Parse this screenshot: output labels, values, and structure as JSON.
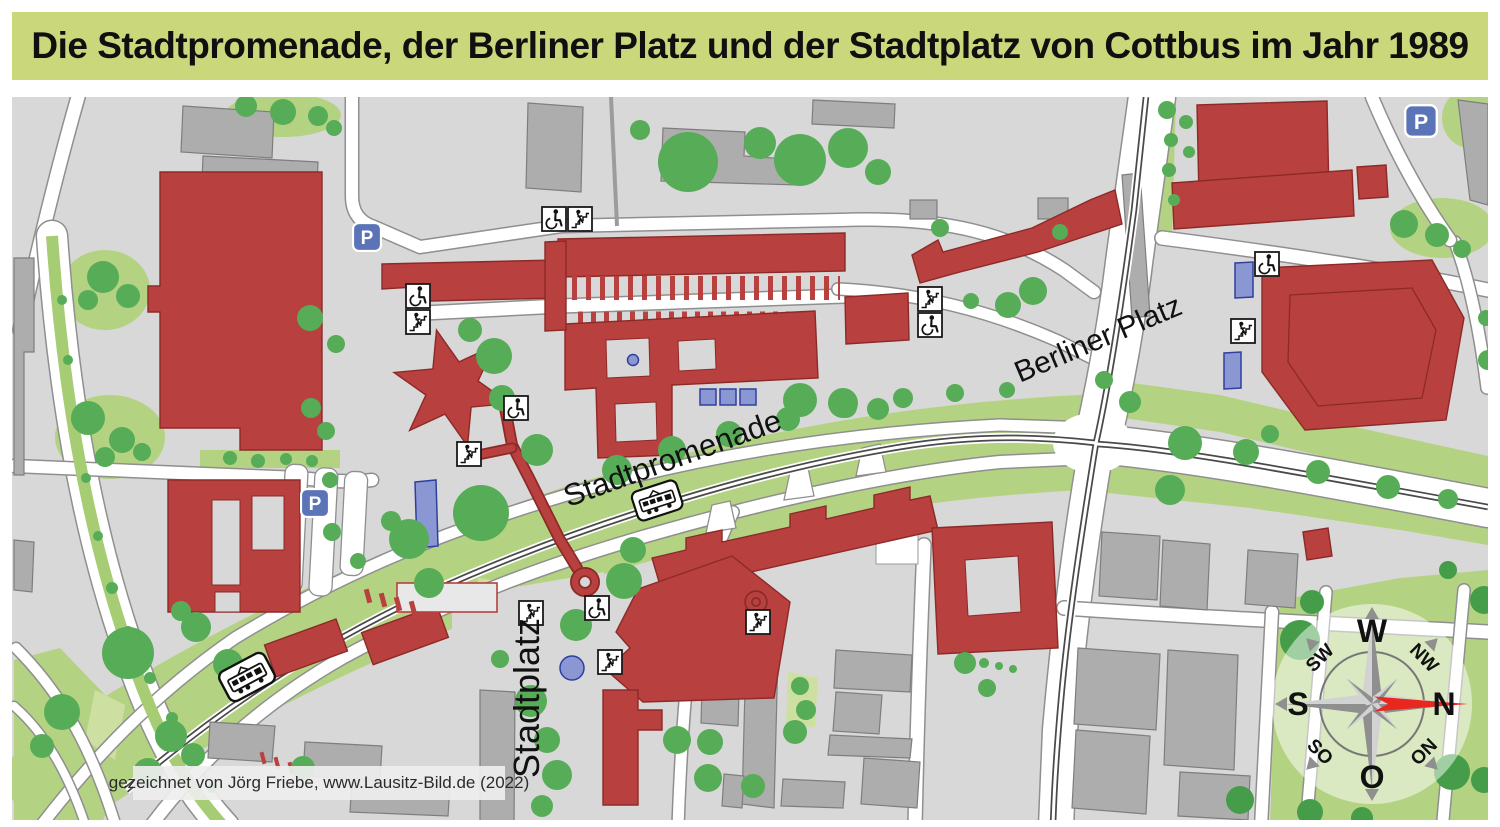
{
  "title": "Die Stadtpromenade, der Berliner Platz und der Stadtplatz von Cottbus im Jahr 1989",
  "attribution": "gezeichnet von Jörg Friebe, www.Lausitz-Bild.de (2022)",
  "labels": {
    "stadtpromenade": "Stadtpromenade",
    "berliner_platz": "Berliner Platz",
    "stadtplatz": "Stadtplatz"
  },
  "compass": {
    "w": "W",
    "n": "N",
    "s": "S",
    "o": "O",
    "nw": "NW",
    "sw": "SW",
    "so": "SO",
    "on": "ON"
  },
  "icons": {
    "parking_label": "P",
    "parking": "parking area",
    "wheelchair": "wheelchair accessible entrance",
    "stairs": "stairs",
    "tram_stop": "tram stop"
  },
  "colors": {
    "title_background": "#cbd77b",
    "map_background": "#d8d8d8",
    "building_red": "#b8403e",
    "building_gray": "#adadad",
    "tree_green": "#57ac57",
    "grass_green": "#b4d382",
    "road_white": "#ffffff",
    "tram_track_dark": "#4a4a4a",
    "parking_sign_blue": "#5b74b8",
    "platform_blue": "#8b97d3",
    "compass_arrow_red": "#e8281e"
  }
}
